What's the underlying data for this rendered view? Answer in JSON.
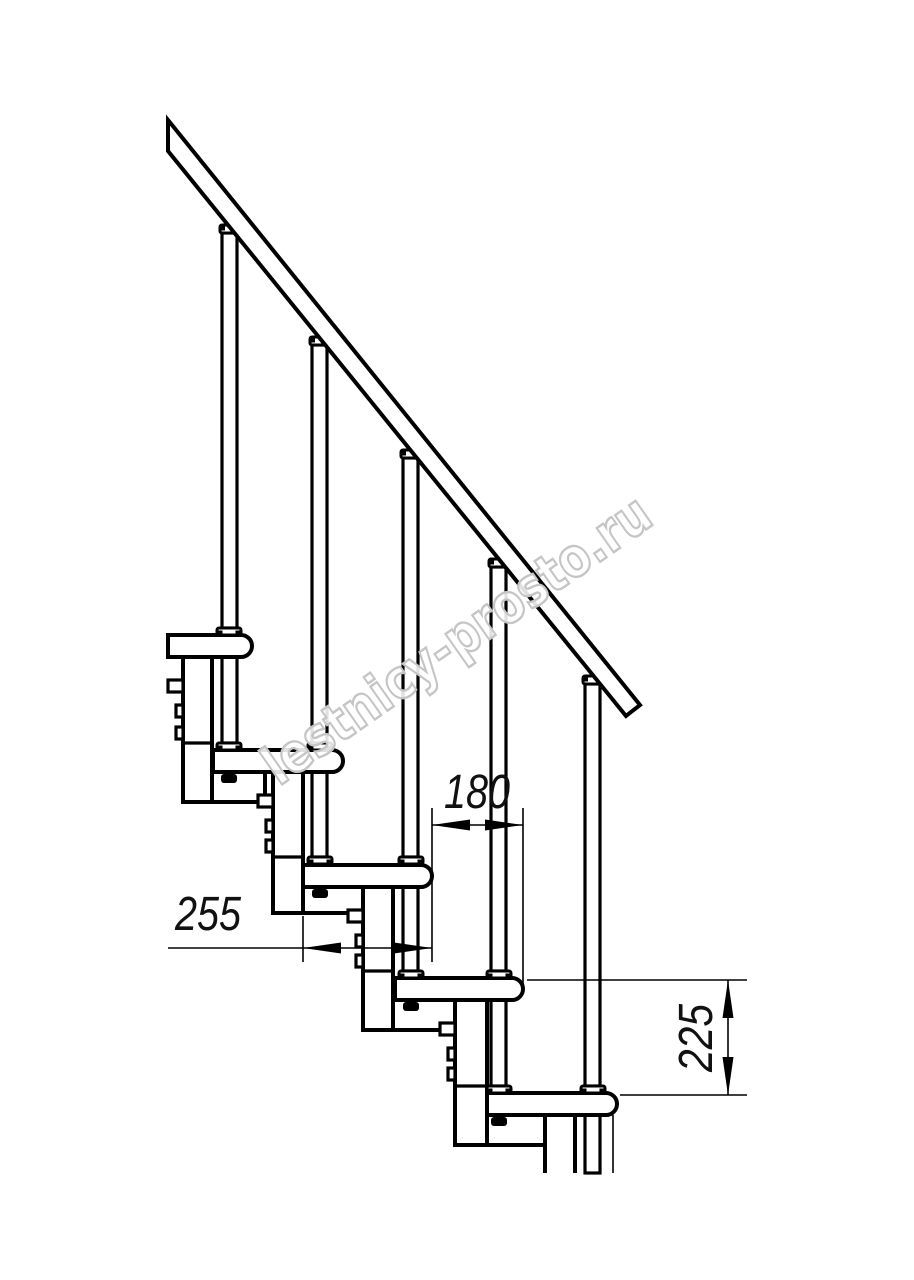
{
  "page": {
    "background_color": "#ffffff",
    "line_color": "#000000"
  },
  "drawing": {
    "kind": "staircase-side-view-technical-drawing",
    "steps_visible": 5,
    "balusters_visible": 5
  },
  "dimensions": {
    "run": {
      "value": "180"
    },
    "depth": {
      "value": "255"
    },
    "rise": {
      "value": "225"
    }
  },
  "watermark": {
    "text": "lestnicy-prosto.ru",
    "color": "#c5c5c5"
  }
}
